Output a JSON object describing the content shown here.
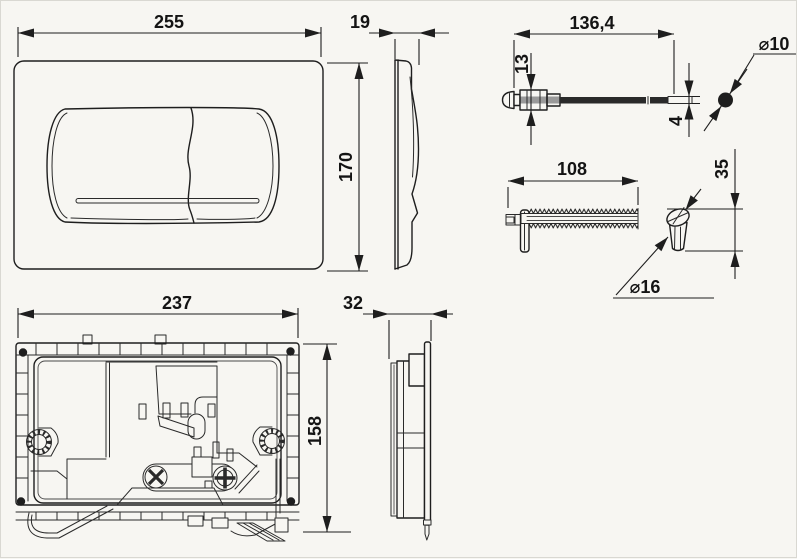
{
  "drawing": {
    "kind": "technical-drawing",
    "line_color": "#1e1e1e",
    "background_color": "#f7f6f2",
    "dimensions": {
      "plate_width": "255",
      "plate_height": "170",
      "plate_depth": "19",
      "rod_length": "136,4",
      "rod_head_height": "13",
      "rod_tip_dia": "4",
      "rod_ball_dia": "⌀10",
      "rack_length": "108",
      "cone_height": "35",
      "cone_dia": "⌀16",
      "frame_width": "237",
      "frame_height": "158",
      "frame_depth": "32"
    }
  }
}
